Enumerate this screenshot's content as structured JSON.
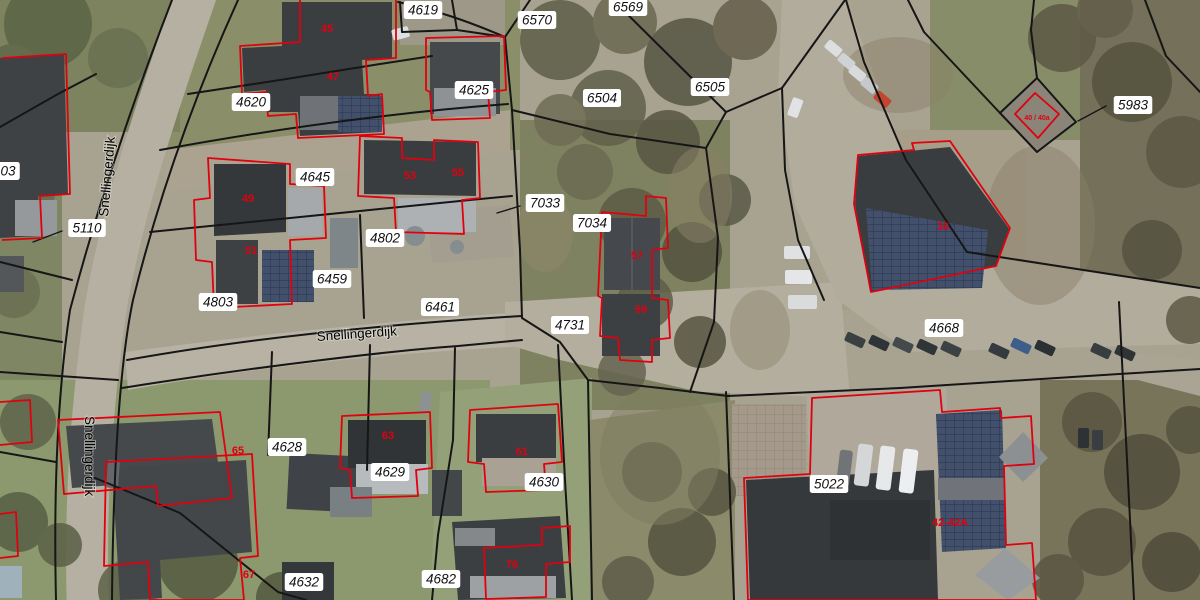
{
  "map": {
    "type": "aerial-cadastral",
    "street_name": "Snellingerdijk",
    "street_labels": [
      {
        "text": "Snellingerdijk",
        "x": 108,
        "y": 217,
        "rotate": -85
      },
      {
        "text": "Snellingerdijk",
        "x": 317,
        "y": 341,
        "rotate": -4
      },
      {
        "text": "Snellingerdijk",
        "x": 85,
        "y": 416,
        "rotate": 90
      }
    ],
    "parcel_labels": [
      {
        "text": "4619",
        "x": 423,
        "y": 10
      },
      {
        "text": "6570",
        "x": 537,
        "y": 20
      },
      {
        "text": "6569",
        "x": 628,
        "y": 7
      },
      {
        "text": "4620",
        "x": 251,
        "y": 102
      },
      {
        "text": "4625",
        "x": 474,
        "y": 90
      },
      {
        "text": "6504",
        "x": 602,
        "y": 98
      },
      {
        "text": "6505",
        "x": 710,
        "y": 87
      },
      {
        "text": "5983",
        "x": 1133,
        "y": 105
      },
      {
        "text": "03",
        "x": 8,
        "y": 171
      },
      {
        "text": "5110",
        "x": 87,
        "y": 228
      },
      {
        "text": "4645",
        "x": 315,
        "y": 177
      },
      {
        "text": "4802",
        "x": 385,
        "y": 238
      },
      {
        "text": "6459",
        "x": 332,
        "y": 279
      },
      {
        "text": "4803",
        "x": 218,
        "y": 302
      },
      {
        "text": "6461",
        "x": 440,
        "y": 307
      },
      {
        "text": "7033",
        "x": 545,
        "y": 203
      },
      {
        "text": "7034",
        "x": 592,
        "y": 223
      },
      {
        "text": "4731",
        "x": 570,
        "y": 325
      },
      {
        "text": "4668",
        "x": 944,
        "y": 328
      },
      {
        "text": "4628",
        "x": 287,
        "y": 447
      },
      {
        "text": "4629",
        "x": 390,
        "y": 472
      },
      {
        "text": "4630",
        "x": 544,
        "y": 482
      },
      {
        "text": "5022",
        "x": 829,
        "y": 484
      },
      {
        "text": "4632",
        "x": 304,
        "y": 582
      },
      {
        "text": "4682",
        "x": 441,
        "y": 579
      }
    ],
    "house_number_labels": [
      {
        "text": "45",
        "x": 327,
        "y": 28
      },
      {
        "text": "47",
        "x": 333,
        "y": 76
      },
      {
        "text": "49",
        "x": 248,
        "y": 198
      },
      {
        "text": "51",
        "x": 251,
        "y": 250
      },
      {
        "text": "53",
        "x": 410,
        "y": 175
      },
      {
        "text": "55",
        "x": 458,
        "y": 172
      },
      {
        "text": "57",
        "x": 637,
        "y": 255
      },
      {
        "text": "59",
        "x": 641,
        "y": 309
      },
      {
        "text": "30",
        "x": 943,
        "y": 226
      },
      {
        "text": "40 / 40a",
        "x": 1037,
        "y": 116,
        "size": 7
      },
      {
        "text": "42-42A",
        "x": 950,
        "y": 522
      },
      {
        "text": "61",
        "x": 522,
        "y": 451
      },
      {
        "text": "63",
        "x": 388,
        "y": 435
      },
      {
        "text": "65",
        "x": 238,
        "y": 450
      },
      {
        "text": "67",
        "x": 249,
        "y": 574
      },
      {
        "text": "76",
        "x": 512,
        "y": 564
      }
    ],
    "colors": {
      "parcel_boundary": "#161616",
      "building_outline": "#e1000f",
      "house_number": "#e1000f",
      "parcel_label_bg": "#ffffff",
      "parcel_label_text": "#111111",
      "street_label_text": "#000000"
    }
  }
}
